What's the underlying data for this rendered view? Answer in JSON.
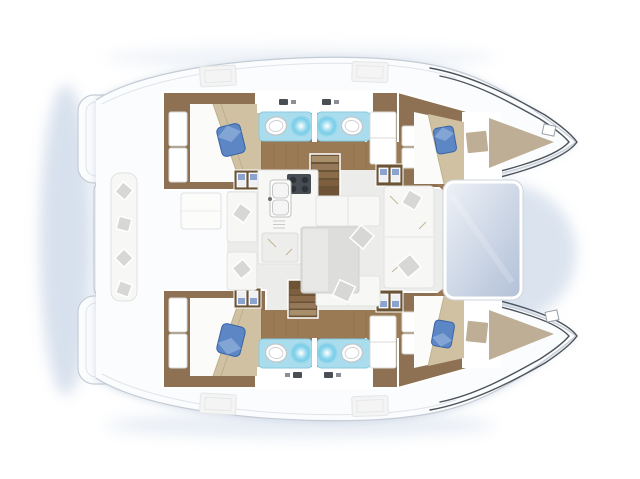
{
  "diagram": {
    "kind": "yacht-floor-plan",
    "vessel_type": "catamaran",
    "view": "top-down deck and accommodation plan",
    "orientation": "bow-right"
  },
  "features": {
    "hulls": 2,
    "cabins": 4,
    "wet_rooms": 4,
    "berths_visible": 4,
    "companionway_stairs": 2,
    "cabin_step_units": 4,
    "cockpit_tables": 1,
    "saloon_tables": 1
  },
  "areas": [
    {
      "id": "stern-platforms",
      "label": "stern transom platforms"
    },
    {
      "id": "aft-cockpit",
      "label": "aft cockpit with bench and table"
    },
    {
      "id": "saloon",
      "label": "saloon with sofa and table"
    },
    {
      "id": "galley",
      "label": "galley with stove and sink"
    },
    {
      "id": "companionway-port",
      "label": "port hull companionway stairs"
    },
    {
      "id": "companionway-starboard",
      "label": "starboard hull companionway stairs"
    },
    {
      "id": "cabin-port-aft",
      "label": "port aft double cabin"
    },
    {
      "id": "cabin-port-forward",
      "label": "port forward double cabin"
    },
    {
      "id": "cabin-starboard-aft",
      "label": "starboard aft double cabin"
    },
    {
      "id": "cabin-starboard-forward",
      "label": "starboard forward double cabin"
    },
    {
      "id": "bathroom-port-aft",
      "label": "port aft bathroom with shower"
    },
    {
      "id": "bathroom-port-forward",
      "label": "port forward bathroom with shower"
    },
    {
      "id": "bathroom-starboard-aft",
      "label": "starboard aft bathroom with shower"
    },
    {
      "id": "bathroom-starboard-forward",
      "label": "starboard forward bathroom with shower"
    },
    {
      "id": "coachroof-window",
      "label": "forward coachroof window"
    },
    {
      "id": "bow-port",
      "label": "port bow with sunpad"
    },
    {
      "id": "bow-starboard",
      "label": "starboard bow with sunpad"
    }
  ],
  "palette": {
    "deck": "#fbfcfd",
    "deck-line": "#c5ccd5",
    "deck-line-faint": "#e0e4ea",
    "hull-ink": "#4e545c",
    "haze": "#b7c8df",
    "wood": "#8d7152",
    "wood-mid": "#9a7a55",
    "wood-dark": "#6b5336",
    "plank": "#7d6445",
    "floor": "#ecedea",
    "seat": "#f7f7f5",
    "seat-line": "#e2e3e0",
    "cushion": "#d7d8d6",
    "tan": "#cfc1a2",
    "tan-dark": "#b9a784",
    "sheet": "#fbfbf9",
    "bow-tan": "#bfae96",
    "aqua": "#a9dcec",
    "aqua-edge": "#8ccadf",
    "glow": "#58c4e6",
    "sink-rim": "#c2c7cb",
    "pillow": "#5d86c4",
    "pillow-dark": "#3a63a8",
    "pillow-hi": "#87a8d8",
    "table": "#dddedb",
    "stove": "#474c52",
    "burner": "#2e3338",
    "step-blue": "#8ba3cf",
    "window-light": "#eef2f8",
    "window-dark": "#b2c0d7"
  },
  "canvas": {
    "width": 640,
    "height": 479,
    "background": "#ffffff"
  }
}
